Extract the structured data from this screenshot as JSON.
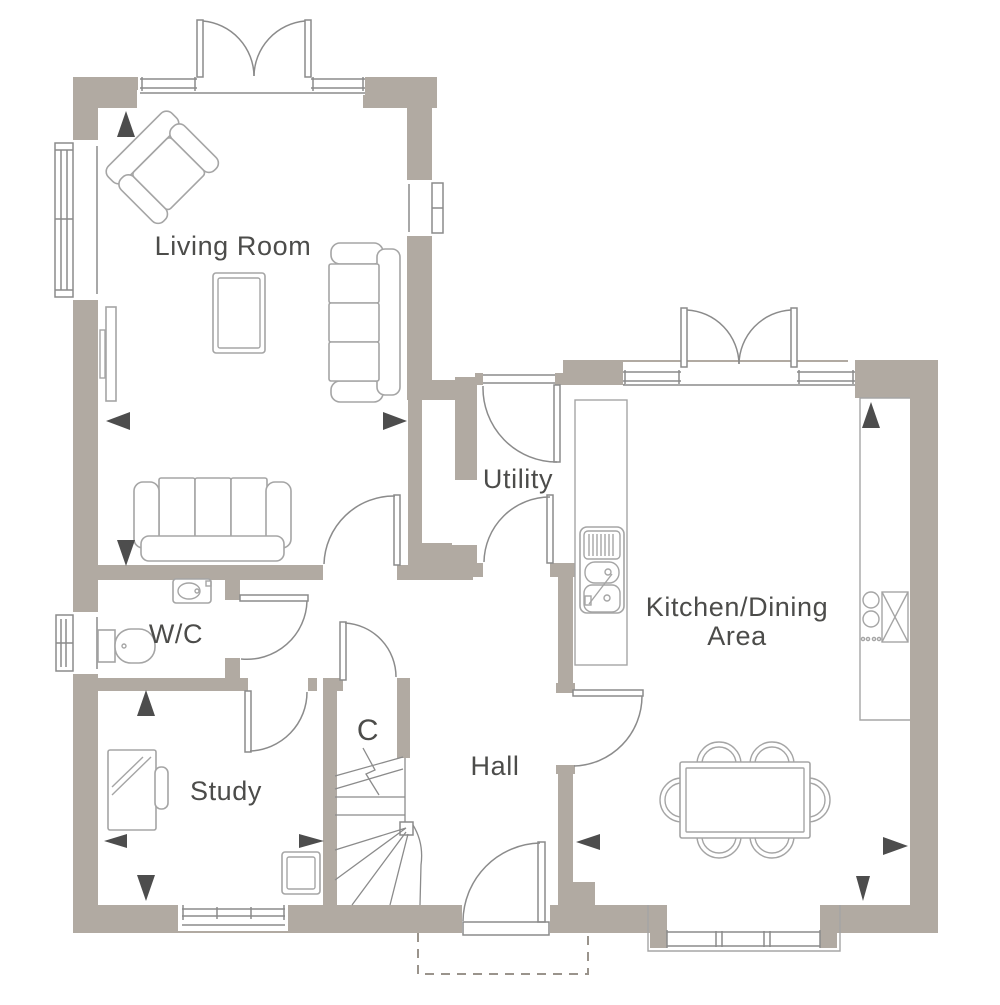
{
  "floor_plan": {
    "type": "ground-floor-plan",
    "labels": {
      "living_room": "Living Room",
      "utility": "Utility",
      "kitchen_line1": "Kitchen/Dining",
      "kitchen_line2": "Area",
      "wc": "W/C",
      "study": "Study",
      "cupboard": "C",
      "hall": "Hall"
    },
    "colors": {
      "wall": "#b1aaa2",
      "line": "#8b8b8b",
      "furniture": "#a5a5a5",
      "text": "#4c4c4a",
      "arrow": "#4d4d4d",
      "dash": "#9a948c"
    }
  }
}
